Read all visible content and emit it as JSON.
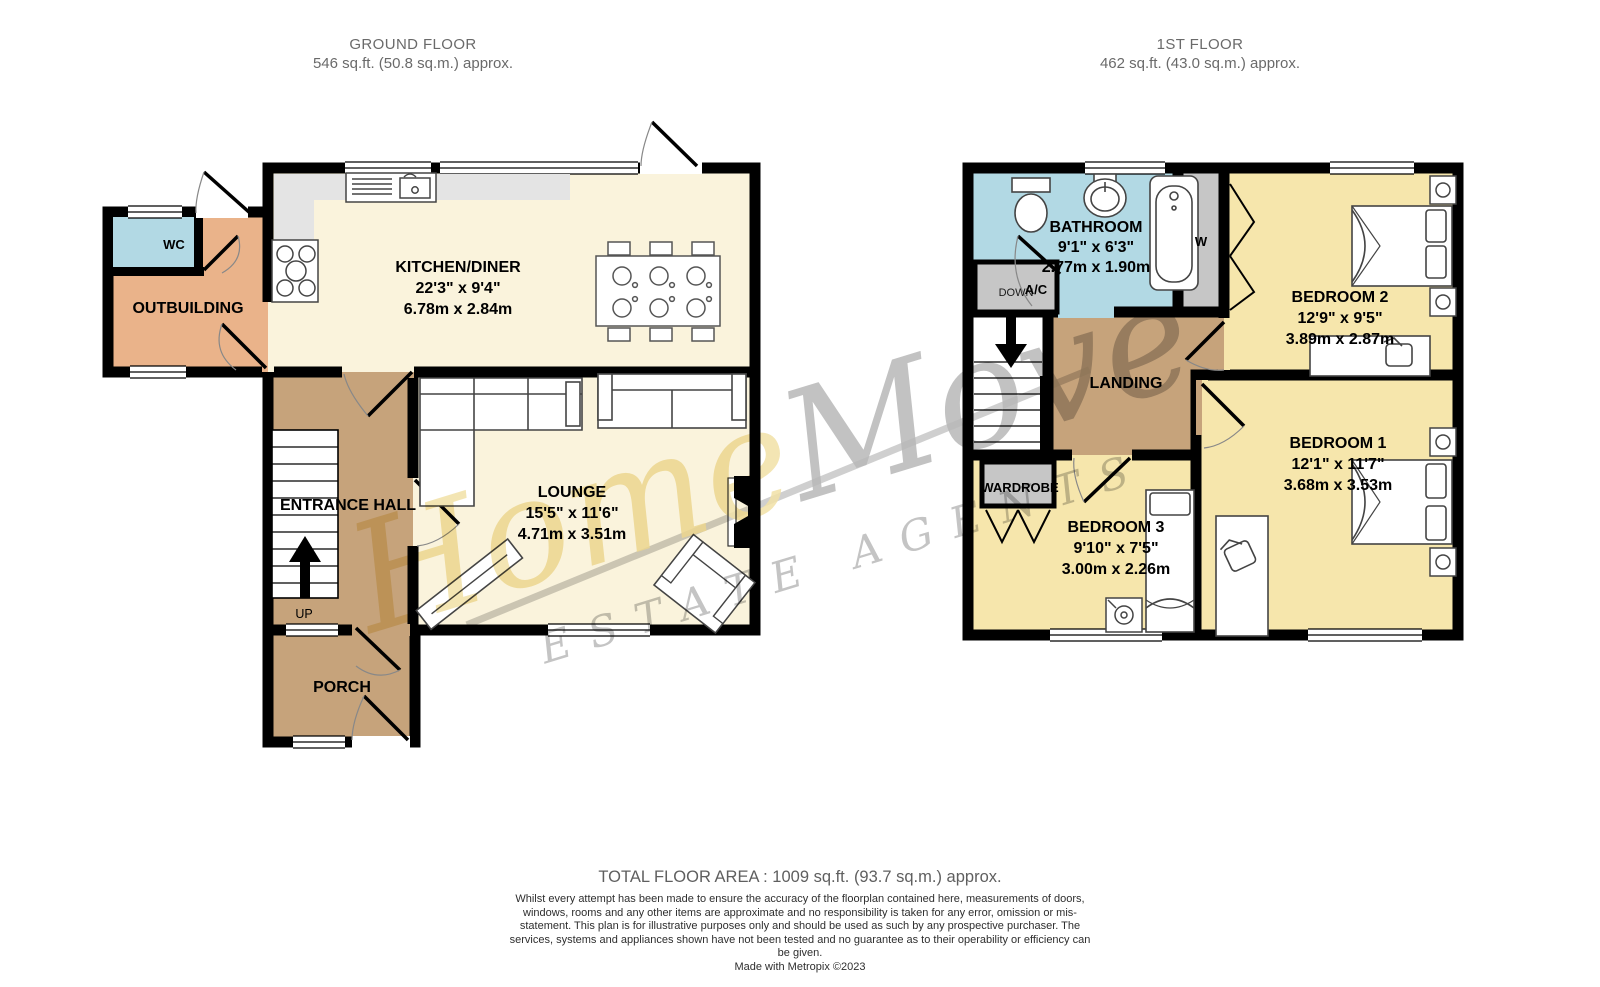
{
  "ground_floor": {
    "title": "GROUND FLOOR",
    "area": "546 sq.ft. (50.8 sq.m.) approx.",
    "rooms": {
      "wc": {
        "name": "WC"
      },
      "outbuilding": {
        "name": "OUTBUILDING"
      },
      "kitchen": {
        "name": "KITCHEN/DINER",
        "dims_ft": "22'3\"  x 9'4\"",
        "dims_m": "6.78m  x 2.84m"
      },
      "lounge": {
        "name": "LOUNGE",
        "dims_ft": "15'5\"  x 11'6\"",
        "dims_m": "4.71m  x 3.51m"
      },
      "hall": {
        "name": "ENTRANCE HALL"
      },
      "porch": {
        "name": "PORCH"
      },
      "up": "UP"
    }
  },
  "first_floor": {
    "title": "1ST FLOOR",
    "area": "462 sq.ft. (43.0 sq.m.) approx.",
    "rooms": {
      "bathroom": {
        "name": "BATHROOM",
        "dims_ft": "9'1\"  x 6'3\"",
        "dims_m": "2.77m  x 1.90m"
      },
      "bedroom1": {
        "name": "BEDROOM 1",
        "dims_ft": "12'1\"  x 11'7\"",
        "dims_m": "3.68m  x 3.53m"
      },
      "bedroom2": {
        "name": "BEDROOM 2",
        "dims_ft": "12'9\"  x 9'5\"",
        "dims_m": "3.89m  x 2.87m"
      },
      "bedroom3": {
        "name": "BEDROOM 3",
        "dims_ft": "9'10\"  x 7'5\"",
        "dims_m": "3.00m  x 2.26m"
      },
      "landing": {
        "name": "LANDING"
      },
      "wardrobe": {
        "name": "WARDROBE"
      },
      "w_closet": {
        "name": "W"
      },
      "airing_cupboard": {
        "name": "A/C"
      },
      "down": "DOWN"
    }
  },
  "watermark": {
    "word1": "Home",
    "word2": "Move",
    "tagline": "ESTATE AGENTS"
  },
  "footer": {
    "total_area": "TOTAL FLOOR AREA : 1009 sq.ft. (93.7 sq.m.) approx.",
    "disclaimer": "Whilst every attempt has been made to ensure the accuracy of the floorplan contained here, measurements of doors, windows, rooms and any other items are approximate and no responsibility is taken for any error, omission or mis-statement. This plan is for illustrative purposes only and should be used as such by any prospective purchaser. The services, systems and appliances shown have not been tested and no guarantee as to their operability or efficiency can be given.",
    "credit": "Made with Metropix ©2023"
  },
  "colors": {
    "room_cream": "#FAF3DC",
    "room_yellow": "#F6E6AC",
    "room_tan": "#C6A37B",
    "room_orange": "#EAB38A",
    "room_blue": "#B2D9E4",
    "closet_gray": "#C6C6C6",
    "counter_gray": "#E4E4E4",
    "wall": "#000000",
    "watermark_yellow": "#EDD98F",
    "watermark_gray": "#A5A5A5"
  }
}
